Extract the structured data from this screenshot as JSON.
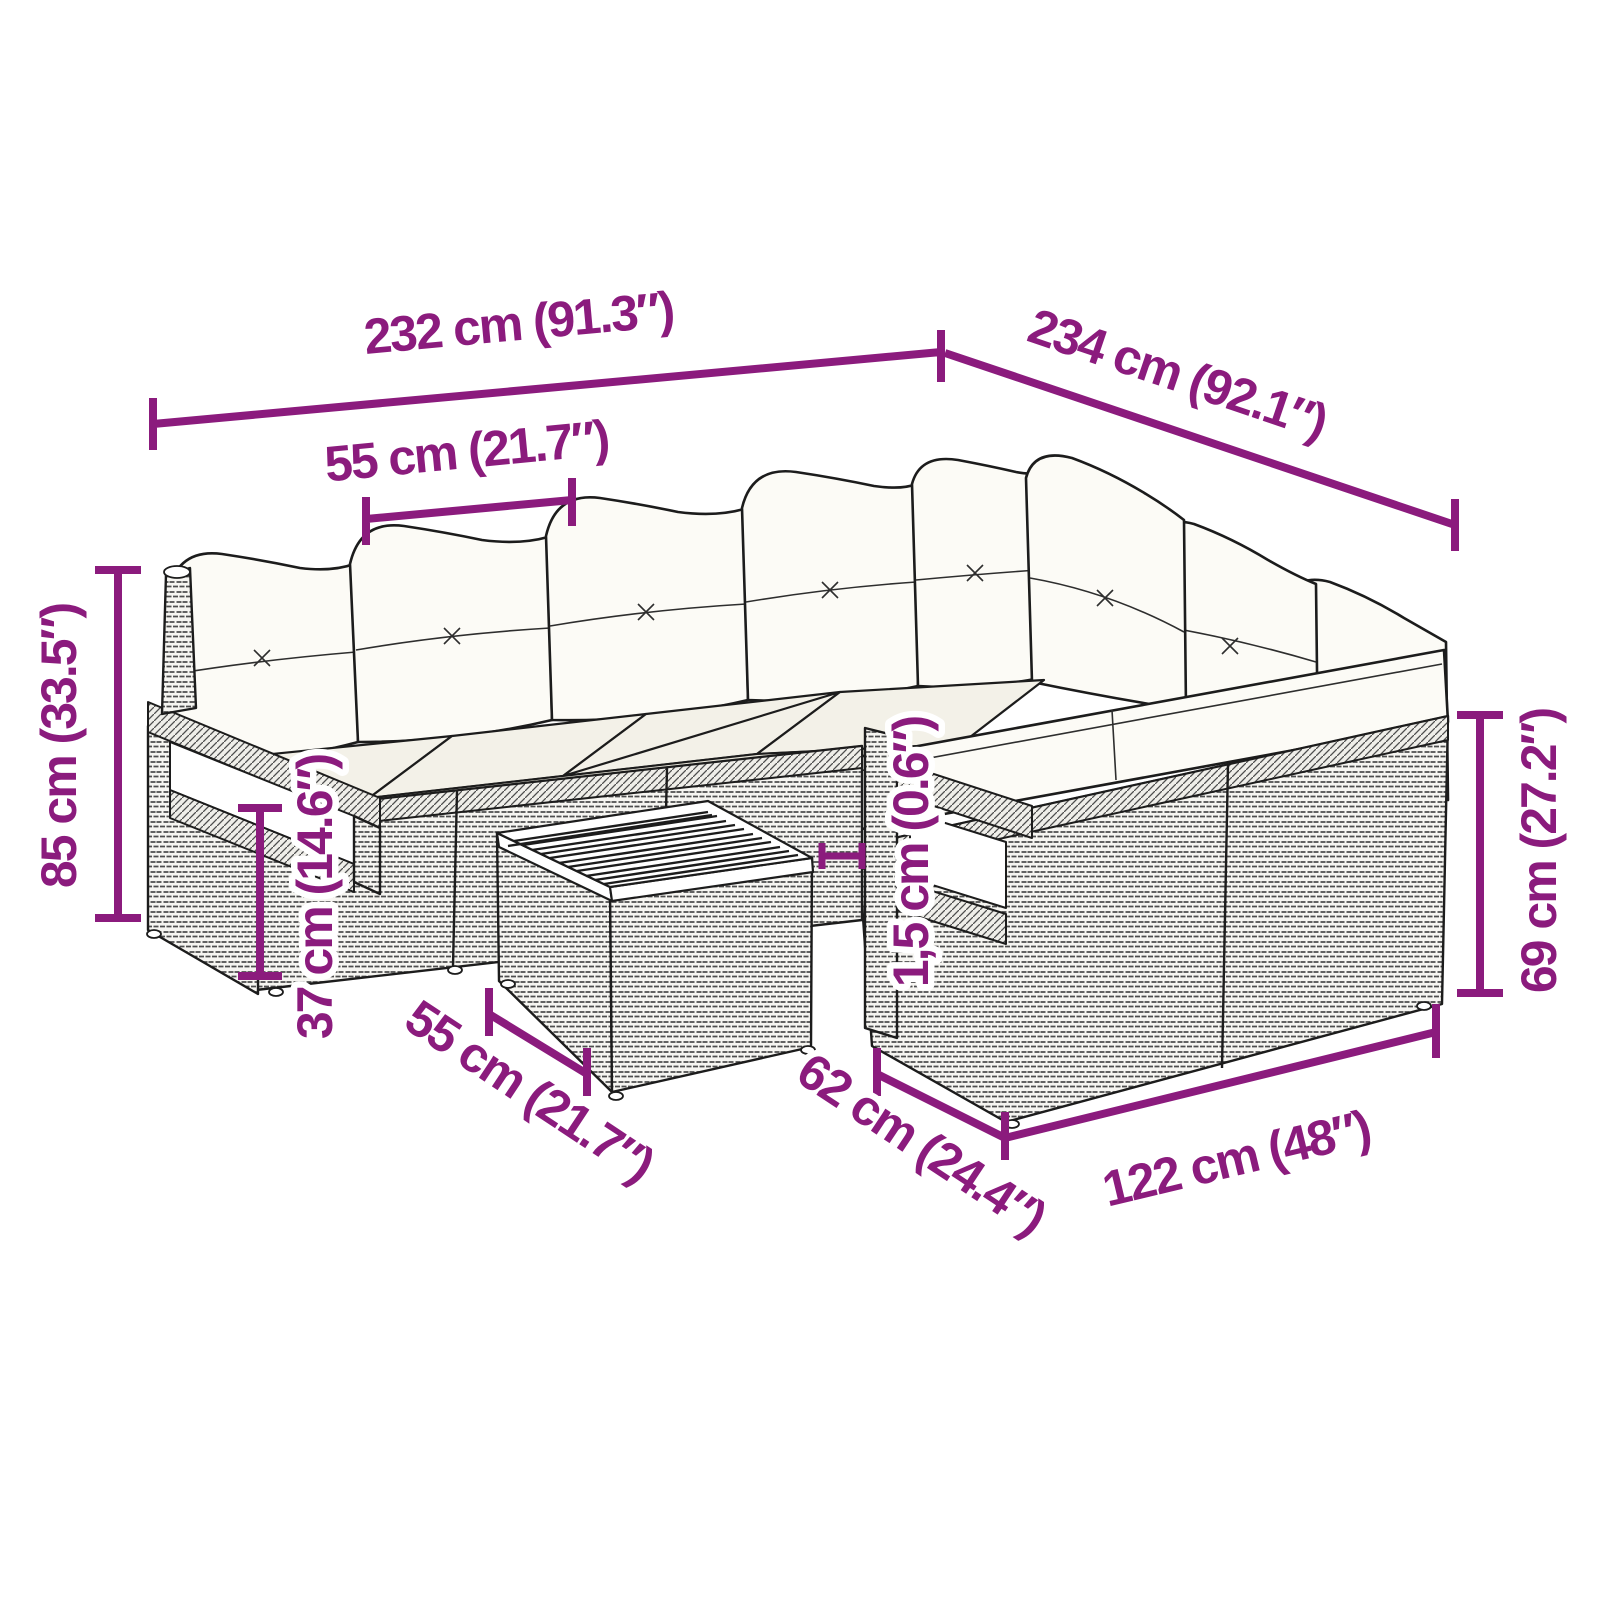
{
  "diagram": {
    "type": "product-dimension-diagram",
    "subject": "rattan-garden-lounge-set-with-cushions-and-coffee-table",
    "style": {
      "background": "#ffffff",
      "dimension_color": "#8B1B7D",
      "line_art_color": "#1c1c1c",
      "cushion_color": "#fcfbf6"
    },
    "dimensions": {
      "overall_width_left": {
        "label": "232 cm (91.3″)"
      },
      "overall_width_right": {
        "label": "234 cm (92.1″)"
      },
      "seat_width": {
        "label": "55 cm (21.7″)"
      },
      "overall_height": {
        "label": "85 cm (33.5″)"
      },
      "seat_height": {
        "label": "37 cm (14.6″)"
      },
      "table_width": {
        "label": "55 cm (21.7″)"
      },
      "tabletop_thickness": {
        "label": "1,5 cm (0.6″)"
      },
      "seat_depth": {
        "label": "62 cm (24.4″)"
      },
      "right_sofa_length": {
        "label": "122 cm (48″)"
      },
      "back_height": {
        "label": "69 cm (27.2″)"
      }
    }
  }
}
